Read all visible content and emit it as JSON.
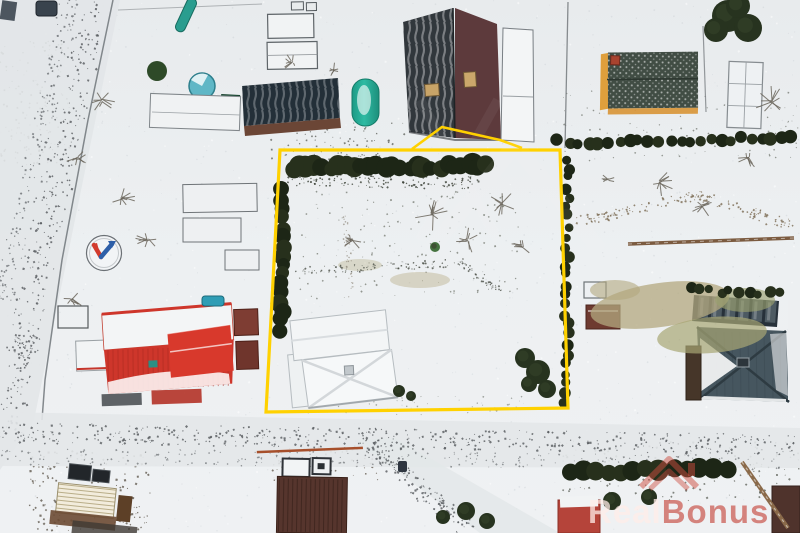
{
  "image": {
    "description": "winter aerial drone photo of a residential land plot outlined in yellow",
    "watermark": {
      "part1": "Real",
      "part2": "Bonus",
      "color_part1": "rgba(255,236,232,0.75)",
      "color_part2": "rgba(193,58,47,0.60)",
      "icon": "roof-icon",
      "icon_color": "rgba(205,75,62,0.50)"
    },
    "plot_outline": {
      "color": "#ffd100",
      "stroke_width": 3.2,
      "points": [
        [
          280,
          150
        ],
        [
          560,
          150
        ],
        [
          568,
          408
        ],
        [
          266,
          412
        ]
      ],
      "bump": [
        [
          412,
          149
        ],
        [
          442,
          127
        ],
        [
          500,
          140
        ],
        [
          522,
          148
        ]
      ]
    },
    "palette": {
      "snow": "#edf0f2",
      "snow_shade": "#dfe3e6",
      "road_track": "#55595c",
      "hedge": "#1d2616",
      "conifer": "#27331f",
      "green_tree": "#2e4a28",
      "red_roof": "#ce362b",
      "red_bright": "#d8392c",
      "maroon_roof": "#5d3a3c",
      "charcoal_roof": "#31373c",
      "navy_roof": "#232f38",
      "rust_band": "#6b4636",
      "slate_roof": "#46565f",
      "glass": "#27313a",
      "teal_tank": "#23ae97",
      "pool_teal": "#5fb7c6",
      "yellow_wall": "#df9f3c",
      "rust_fence": "#a64f2b",
      "brown_barn": "#56352d",
      "dark_shed": "#4f332c",
      "grass": "#b3a87f",
      "skylight": "#c8a468",
      "white_roof": "#f3f5f6",
      "logo_red": "#d23b2e",
      "logo_blue": "#2e5fa8"
    }
  }
}
